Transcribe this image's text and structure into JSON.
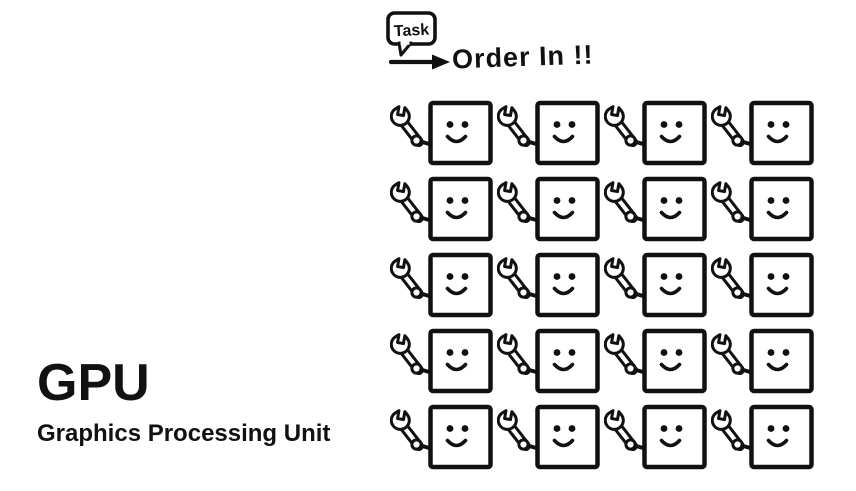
{
  "page": {
    "background": "#ffffff",
    "ink": "#111111"
  },
  "title": {
    "acronym": "GPU",
    "full_name": "Graphics Processing Unit"
  },
  "annotation": {
    "bubble_label": "Task",
    "arrow_label": "Order In !!",
    "icons": {
      "bubble": "speech-bubble-icon",
      "arrow": "right-arrow-icon"
    }
  },
  "grid": {
    "rows": 5,
    "cols": 4,
    "unit_icon": "wrench-icon",
    "unit_face": "smiley-face"
  }
}
